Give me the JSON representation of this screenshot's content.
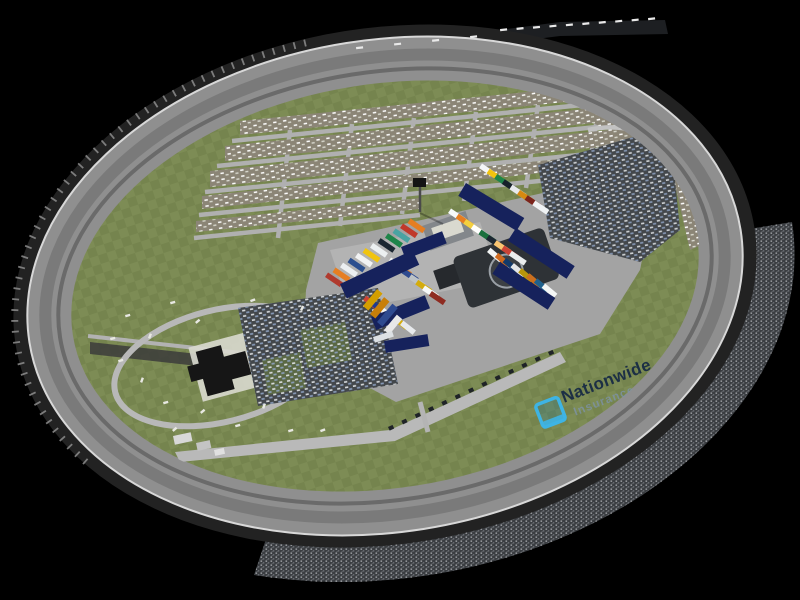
{
  "watermark": {
    "icon": "nationwide-frame-icon",
    "line1": "Nationwide",
    "line2": "Insurance"
  },
  "colors": {
    "background": "#000000",
    "track_asphalt": "#8f8f8f",
    "track_wall": "#d8d8d8",
    "track_inner_edge": "#6a6a6a",
    "track_rim": "#222222",
    "grass_a": "#75844e",
    "grass_b": "#7d8c55",
    "camp_base": "#8b8576",
    "camp_speck": "#ffffff",
    "road_light": "#b2b2b2",
    "paddock": "#a3a3a3",
    "paddock_light": "#c9c9c2",
    "lot_dark": "#43474b",
    "car_speck_a": "#e4e7ea",
    "car_speck_b": "#8fa3c4",
    "crowd_base": "#3a3d41",
    "crowd_speck_a": "#caccd0",
    "crowd_speck_b": "#85898f",
    "trailer_navy": "#16225c",
    "building_dark": "#161616",
    "building_gray": "#83878b",
    "roof_white": "#d9d9cf",
    "helipad_dark": "#2e3236",
    "helipad_ring": "#9aa0a6",
    "stand_suite": "#141619",
    "billboard_white": "#e9e9e9",
    "logo_navy": "#1c2f45",
    "logo_sub": "#7d93a8",
    "logo_teal": "#3eb4e4"
  },
  "scene": {
    "hauler_rows": [
      {
        "x": 325,
        "y": 277,
        "dx": 7.5,
        "dy": -4.9,
        "angle": -56,
        "w": 5.5,
        "h": 18,
        "colors": [
          "#b03a2e",
          "#e67e22",
          "#eceff1",
          "#2c4f8f",
          "#f2f3f4",
          "#f1c40f",
          "#ecf0f1",
          "#1b2631",
          "#1e8449",
          "#4aa3a2",
          "#c0392b",
          "#e67e22"
        ]
      },
      {
        "x": 388,
        "y": 262,
        "dx": 6.8,
        "dy": 5.6,
        "angle": -56,
        "w": 5.5,
        "h": 17,
        "colors": [
          "#f4f6f7",
          "#e67e22",
          "#2e4a8f",
          "#bdc3c7",
          "#d4ac0d",
          "#f7f9f9",
          "#8e2b21"
        ]
      },
      {
        "x": 363,
        "y": 300,
        "dx": 7.4,
        "dy": 5.0,
        "angle": -52,
        "w": 5.5,
        "h": 16,
        "colors": [
          "#cb4335",
          "#1f3a93",
          "#f4f6f6",
          "#10194d",
          "#d4ac0d",
          "#e8eaed"
        ]
      },
      {
        "x": 479,
        "y": 168,
        "dx": 7.6,
        "dy": 5.3,
        "angle": -56,
        "w": 5.5,
        "h": 17,
        "colors": [
          "#f4f6f7",
          "#f1c40f",
          "#1e8449",
          "#17202a",
          "#e8eaed",
          "#d68910",
          "#7b241c",
          "#f0f3f4"
        ]
      },
      {
        "x": 448,
        "y": 213,
        "dx": 7.6,
        "dy": 5.3,
        "angle": -56,
        "w": 5.5,
        "h": 18,
        "colors": [
          "#f7f9f9",
          "#e67e22",
          "#f4d03f",
          "#ffffff",
          "#196f3d",
          "#1b2631",
          "#f8c471",
          "#cb4335",
          "#eaeded"
        ]
      },
      {
        "x": 487,
        "y": 252,
        "dx": 7.8,
        "dy": 5.1,
        "angle": -50,
        "w": 5.5,
        "h": 16,
        "colors": [
          "#f2f4f4",
          "#cf6a1f",
          "#123a6b",
          "#e5e7e9",
          "#b7950b",
          "#ca6f1e",
          "#1f618d",
          "#f4f6f6"
        ]
      }
    ],
    "trailers": [
      {
        "x": 340,
        "y": 284,
        "angle": -25,
        "w": 80,
        "h": 16
      },
      {
        "x": 371,
        "y": 317,
        "angle": -22,
        "w": 58,
        "h": 14
      },
      {
        "x": 401,
        "y": 247,
        "angle": -21,
        "w": 44,
        "h": 13
      },
      {
        "x": 466,
        "y": 183,
        "angle": 31,
        "w": 68,
        "h": 15
      },
      {
        "x": 516,
        "y": 228,
        "angle": 33,
        "w": 70,
        "h": 15
      },
      {
        "x": 500,
        "y": 262,
        "angle": 33,
        "w": 66,
        "h": 14
      },
      {
        "x": 384,
        "y": 341,
        "angle": -9,
        "w": 44,
        "h": 12
      }
    ],
    "buses": [
      {
        "x": 363,
        "y": 306,
        "angle": -50,
        "w": 22,
        "h": 7,
        "color": "#d39e00"
      },
      {
        "x": 370,
        "y": 314,
        "angle": -50,
        "w": 22,
        "h": 7,
        "color": "#c87f0a"
      },
      {
        "x": 377,
        "y": 322,
        "angle": -50,
        "w": 24,
        "h": 7,
        "color": "#2e4a8f"
      },
      {
        "x": 384,
        "y": 330,
        "angle": -50,
        "w": 20,
        "h": 7,
        "color": "#e8e8e8"
      },
      {
        "x": 373,
        "y": 337,
        "angle": -18,
        "w": 20,
        "h": 6,
        "color": "#dde1e4"
      }
    ],
    "small_buildings": [
      {
        "x": 173,
        "y": 436,
        "angle": -12,
        "w": 18,
        "h": 9,
        "color": "#d8d8d8"
      },
      {
        "x": 196,
        "y": 443,
        "angle": -12,
        "w": 14,
        "h": 8,
        "color": "#c4c4c4"
      },
      {
        "x": 214,
        "y": 450,
        "angle": -12,
        "w": 10,
        "h": 6,
        "color": "#e0e0e0"
      },
      {
        "x": 640,
        "y": 455,
        "angle": -27,
        "w": 90,
        "h": 20,
        "color": "#141619"
      },
      {
        "x": 425,
        "y": 560,
        "angle": -8,
        "w": 180,
        "h": 24,
        "color": "#0c0d0f"
      }
    ],
    "rv_specks": [
      [
        125,
        315,
        -15
      ],
      [
        148,
        338,
        -70
      ],
      [
        170,
        302,
        -15
      ],
      [
        195,
        322,
        -40
      ],
      [
        118,
        360,
        -15
      ],
      [
        140,
        382,
        -70
      ],
      [
        163,
        402,
        -15
      ],
      [
        200,
        412,
        -40
      ],
      [
        235,
        425,
        -15
      ],
      [
        262,
        408,
        -70
      ],
      [
        288,
        430,
        -15
      ],
      [
        172,
        430,
        -40
      ],
      [
        110,
        338,
        -15
      ],
      [
        250,
        300,
        -20
      ],
      [
        300,
        310,
        -65
      ],
      [
        320,
        430,
        -20
      ]
    ],
    "pit_boxes": {
      "x1": 388,
      "y1": 427,
      "x2": 548,
      "y2": 352,
      "count": 13,
      "w": 5,
      "h": 4,
      "angle": -25
    },
    "billboards": [
      {
        "x1": 500,
        "y1": 29,
        "x2": 648,
        "y2": 18,
        "count": 10
      },
      {
        "x1": 356,
        "y1": 47,
        "x2": 470,
        "y2": 36,
        "count": 4
      }
    ]
  }
}
